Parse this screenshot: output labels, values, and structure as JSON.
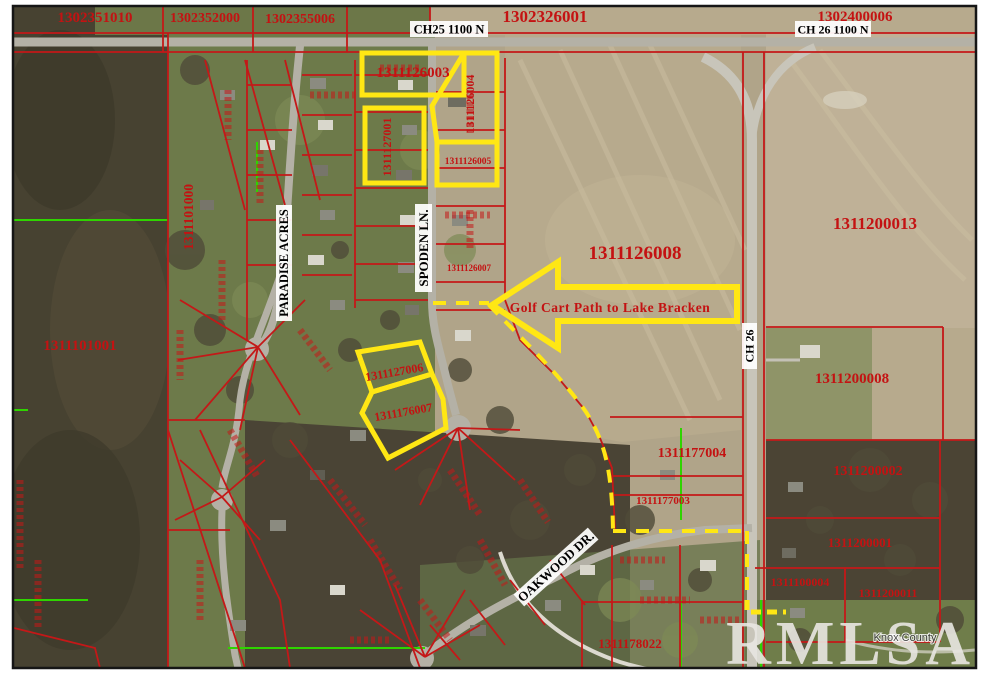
{
  "watermark": {
    "brand": "RMLSA",
    "sub": "Knox County"
  },
  "roads": {
    "ch25_1100n": "CH25 1100 N",
    "ch26_1100n": "CH 26 1100 N",
    "spoden_ln": "SPODEN LN.",
    "paradise_acres": "PARADISE ACRES",
    "oakwood_dr": "OAKWOOD DR.",
    "ch26": "CH 26"
  },
  "annotation": {
    "golf_cart_path": "Golf Cart Path to Lake Bracken"
  },
  "parcels": {
    "p1302351010": "1302351010",
    "p1302352000": "1302352000",
    "p1302355006": "1302355006",
    "p1302326001": "1302326001",
    "p1302400006": "1302400006",
    "p1311126003": "1311126003",
    "p1311126004": "1311126004",
    "p1311126005": "1311126005",
    "p1311127001": "1311127001",
    "p1311101000": "1311101000",
    "p1311101001": "1311101001",
    "p1311126008": "1311126008",
    "p1311126007": "1311126007",
    "p1311200013": "1311200013",
    "p1311200008": "1311200008",
    "p1311127006": "1311127006",
    "p1311176007": "1311176007",
    "p1311177004": "1311177004",
    "p1311177003": "1311177003",
    "p1311200002": "1311200002",
    "p1311200001": "1311200001",
    "p1311100004": "1311100004",
    "p1311200011": "1311200011",
    "p1311178022": "1311178022"
  },
  "colors": {
    "parcel_line": "#c41818",
    "parcel_text": "#c41212",
    "highlight_yellow": "#ffe714",
    "section_line_green": "#2fd400",
    "road_label_bg": "#ffffff",
    "road_label_text": "#000000",
    "watermark": "#e9e7e2"
  }
}
